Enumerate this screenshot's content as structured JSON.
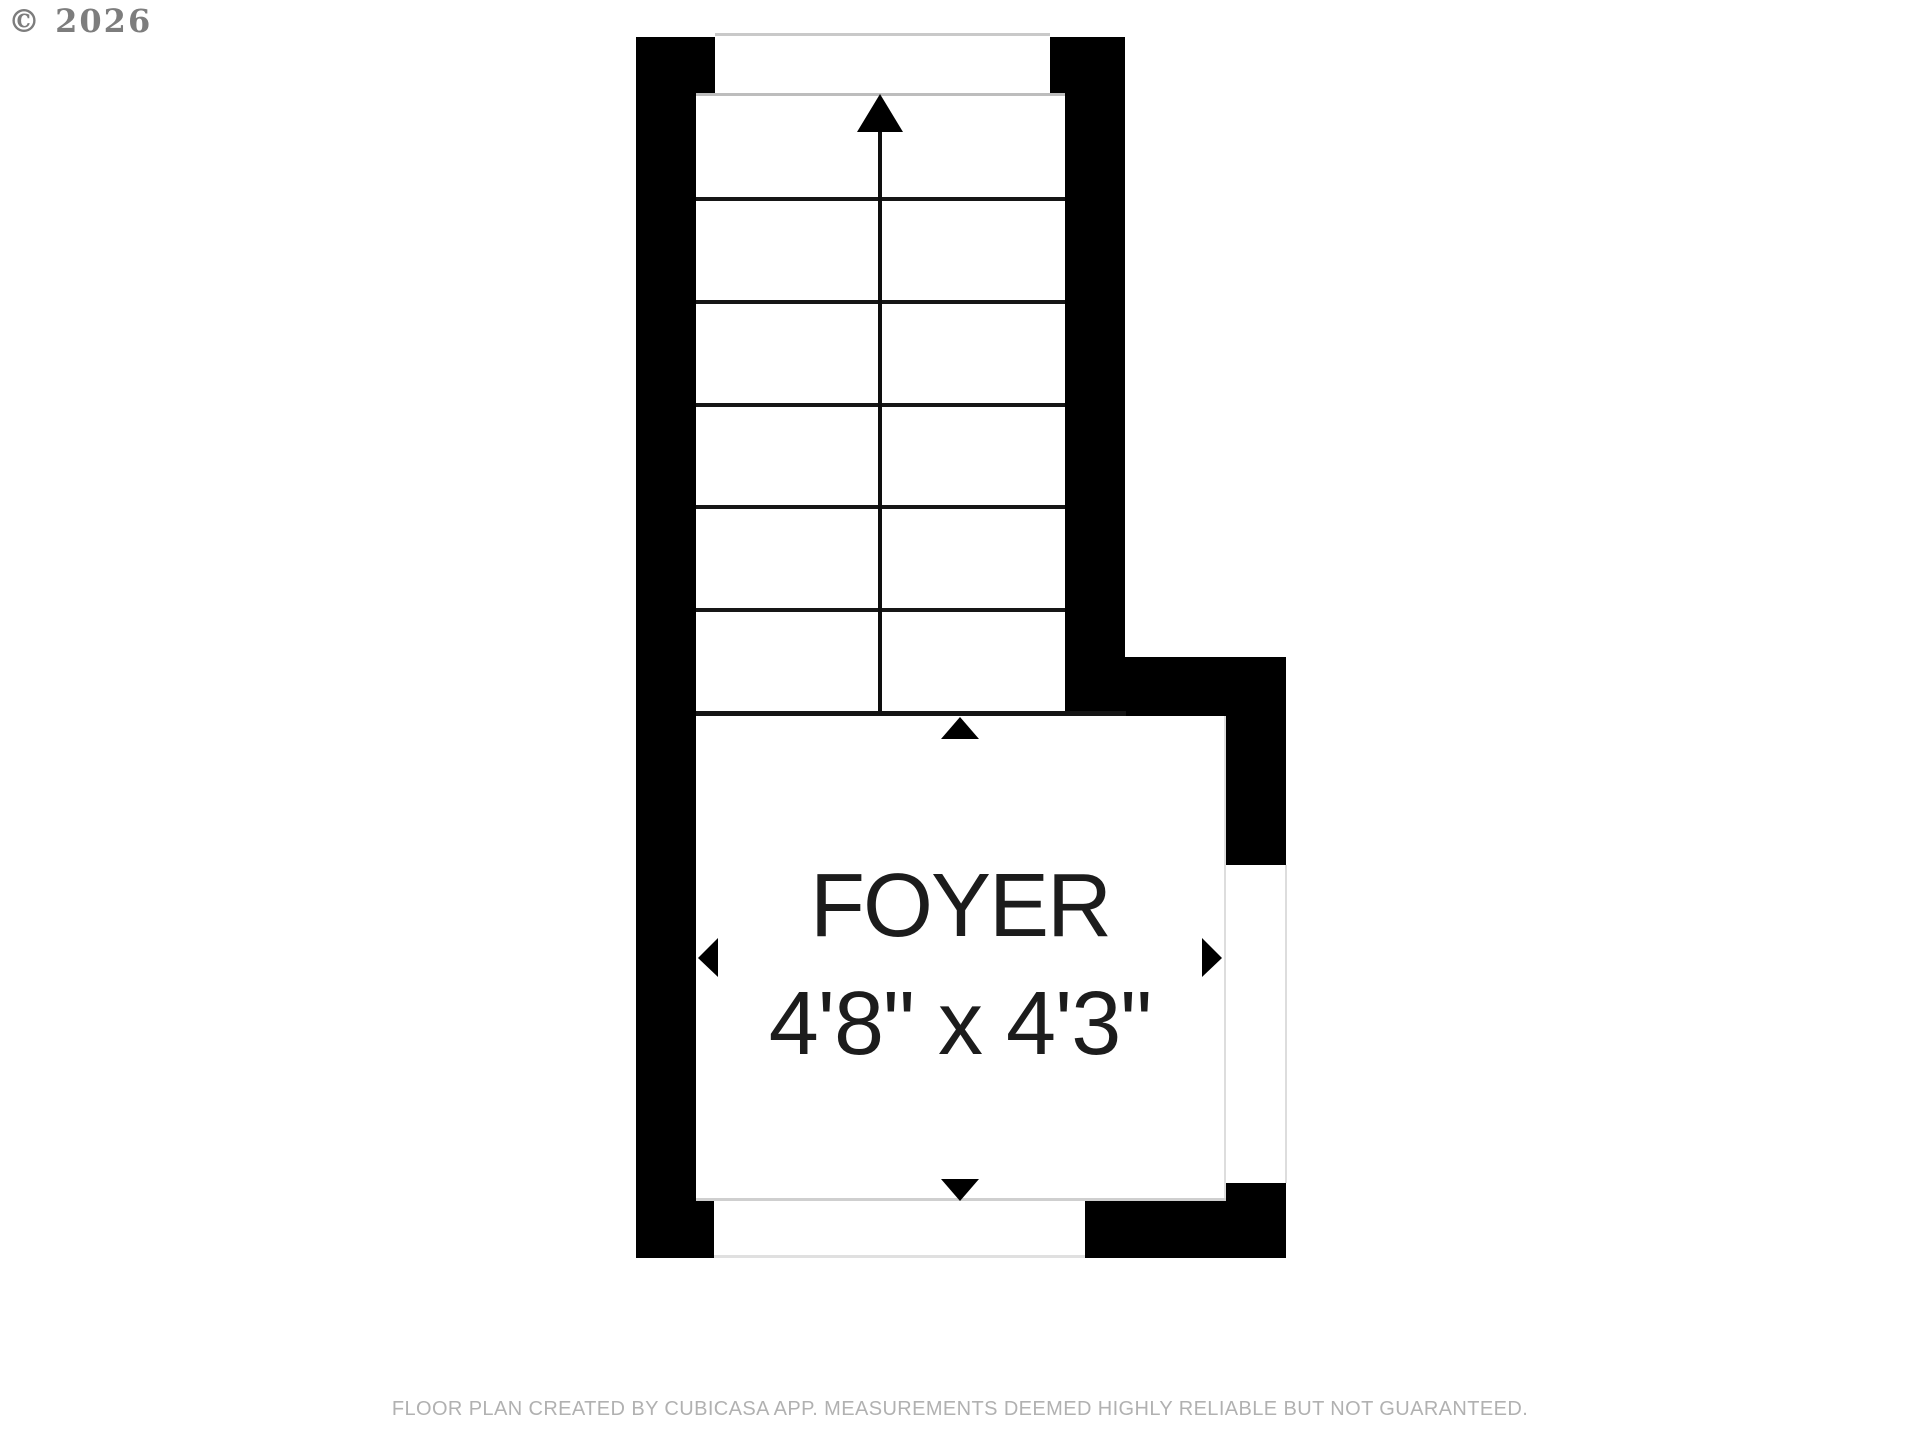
{
  "meta": {
    "copyright": "© 2026"
  },
  "plan": {
    "room": {
      "name": "FOYER",
      "dimensions": "4'8\" x 4'3\""
    },
    "stairs": {
      "direction": "up",
      "rows": 6,
      "tread_lines": 5,
      "run_columns": 2
    },
    "markers": {
      "stair_direction_icon": "up-arrow-icon",
      "room_edge_icons": [
        "triangle-up-icon",
        "triangle-down-icon",
        "triangle-left-icon",
        "triangle-right-icon"
      ]
    },
    "colors": {
      "wall": "#000000",
      "tread_line": "#161616",
      "opening_line": "#cccccc",
      "label_text": "#1c1c1c",
      "copyright_text": "#7d7d7d",
      "footer_text": "#b1b1b1",
      "background": "#ffffff"
    }
  },
  "footer": {
    "disclaimer": "FLOOR PLAN CREATED BY CUBICASA APP. MEASUREMENTS DEEMED HIGHLY RELIABLE BUT NOT GUARANTEED."
  }
}
